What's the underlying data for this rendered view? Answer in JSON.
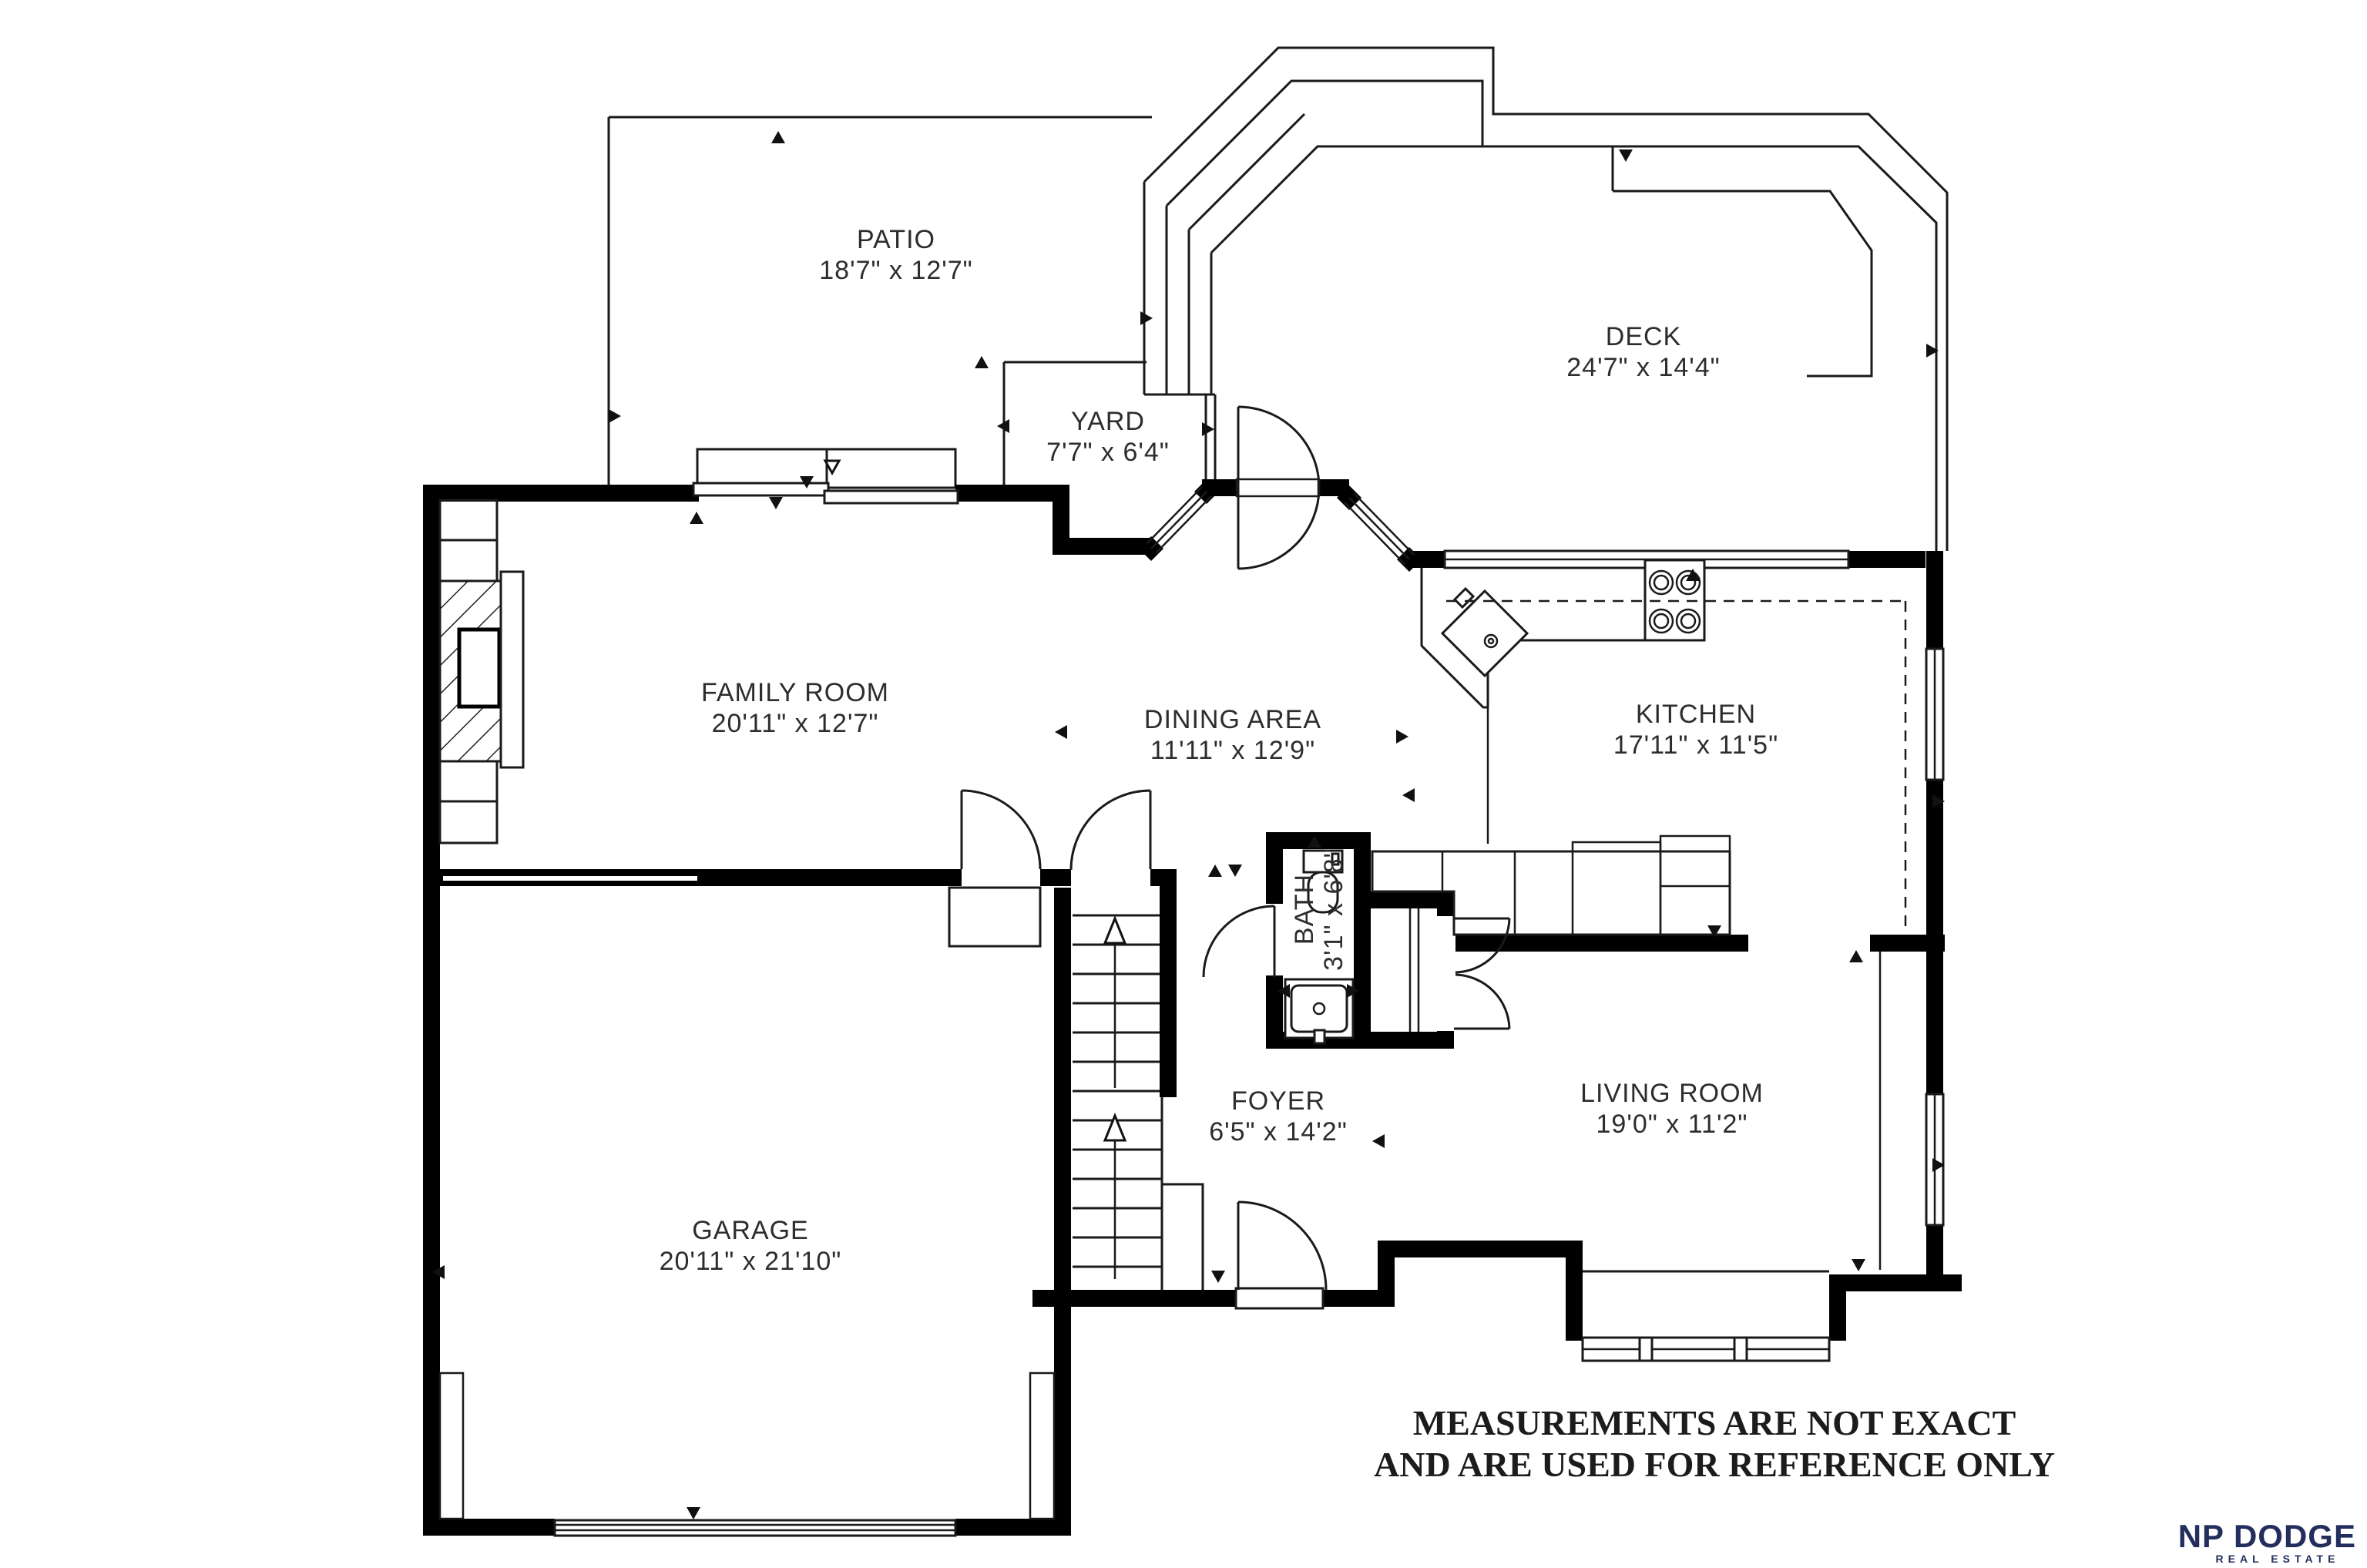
{
  "plan": {
    "rooms": {
      "patio": {
        "name": "PATIO",
        "dims": "18'7\" x 12'7\""
      },
      "deck": {
        "name": "DECK",
        "dims": "24'7\" x 14'4\""
      },
      "yard": {
        "name": "YARD",
        "dims": "7'7\" x 6'4\""
      },
      "family_room": {
        "name": "FAMILY ROOM",
        "dims": "20'11\" x 12'7\""
      },
      "dining_area": {
        "name": "DINING AREA",
        "dims": "11'11\" x 12'9\""
      },
      "kitchen": {
        "name": "KITCHEN",
        "dims": "17'11\" x 11'5\""
      },
      "bath": {
        "name": "BATH",
        "dims": "3'1\" x 6'8\""
      },
      "foyer": {
        "name": "FOYER",
        "dims": "6'5\" x 14'2\""
      },
      "living_room": {
        "name": "LIVING ROOM",
        "dims": "19'0\" x 11'2\""
      },
      "garage": {
        "name": "GARAGE",
        "dims": "20'11\" x 21'10\""
      }
    },
    "disclaimer": {
      "line1": "MEASUREMENTS ARE NOT EXACT",
      "line2": "AND ARE USED FOR REFERENCE ONLY"
    },
    "logo": {
      "name": "NP DODGE",
      "tagline": "REAL ESTATE",
      "color": "#232e5c"
    },
    "colors": {
      "wall": "#000000",
      "line": "#1a1a1a",
      "text": "#2d2d2d",
      "background": "#ffffff"
    }
  }
}
